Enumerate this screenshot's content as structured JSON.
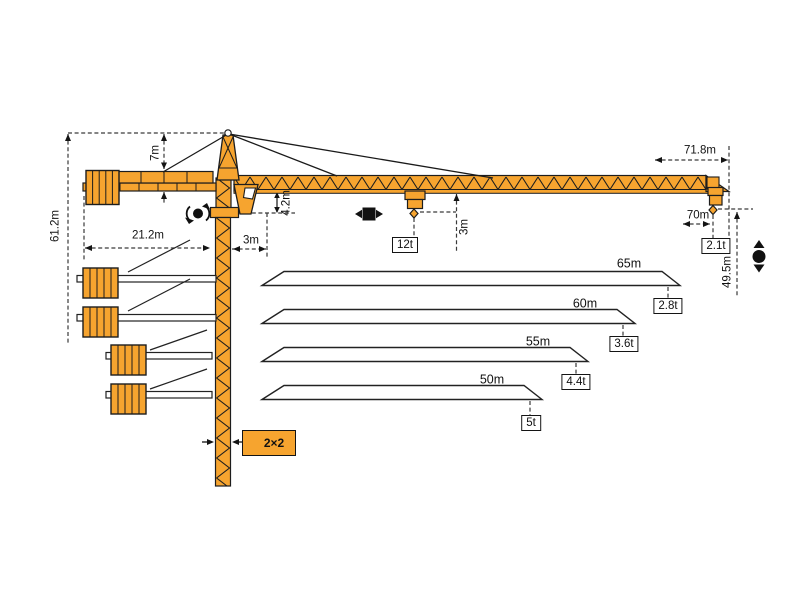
{
  "colors": {
    "crane": "#F6A42F",
    "outline": "#1D1D1D",
    "dim": "#3A3A3A",
    "text": "#111111",
    "bg": "#FFFFFF"
  },
  "crane": {
    "dimensions": {
      "total_height": "61.2m",
      "cathead_height": "7m",
      "counter_jib_radius": "21.2m",
      "counter_jib_clearance": "3m",
      "jib_section_height": "4.2m",
      "hook_to_jib": "3m",
      "max_radius": "71.8m",
      "max_hook_radius": "70m",
      "hook_height": "49.5m"
    },
    "loads": {
      "max_capacity": "12t",
      "tip_load": "2.1t"
    },
    "mast": {
      "section_size": "2×2"
    }
  },
  "jib_variants": [
    {
      "length": "65m",
      "tip_load": "2.8t"
    },
    {
      "length": "60m",
      "tip_load": "3.6t"
    },
    {
      "length": "55m",
      "tip_load": "4.4t"
    },
    {
      "length": "50m",
      "tip_load": "5t"
    }
  ],
  "icons": {
    "slewing": "slewing-rotation-icon",
    "trolley": "trolley-travel-icon",
    "hoist": "hook-hoist-icon",
    "mast_section": "mast-section-icon"
  }
}
